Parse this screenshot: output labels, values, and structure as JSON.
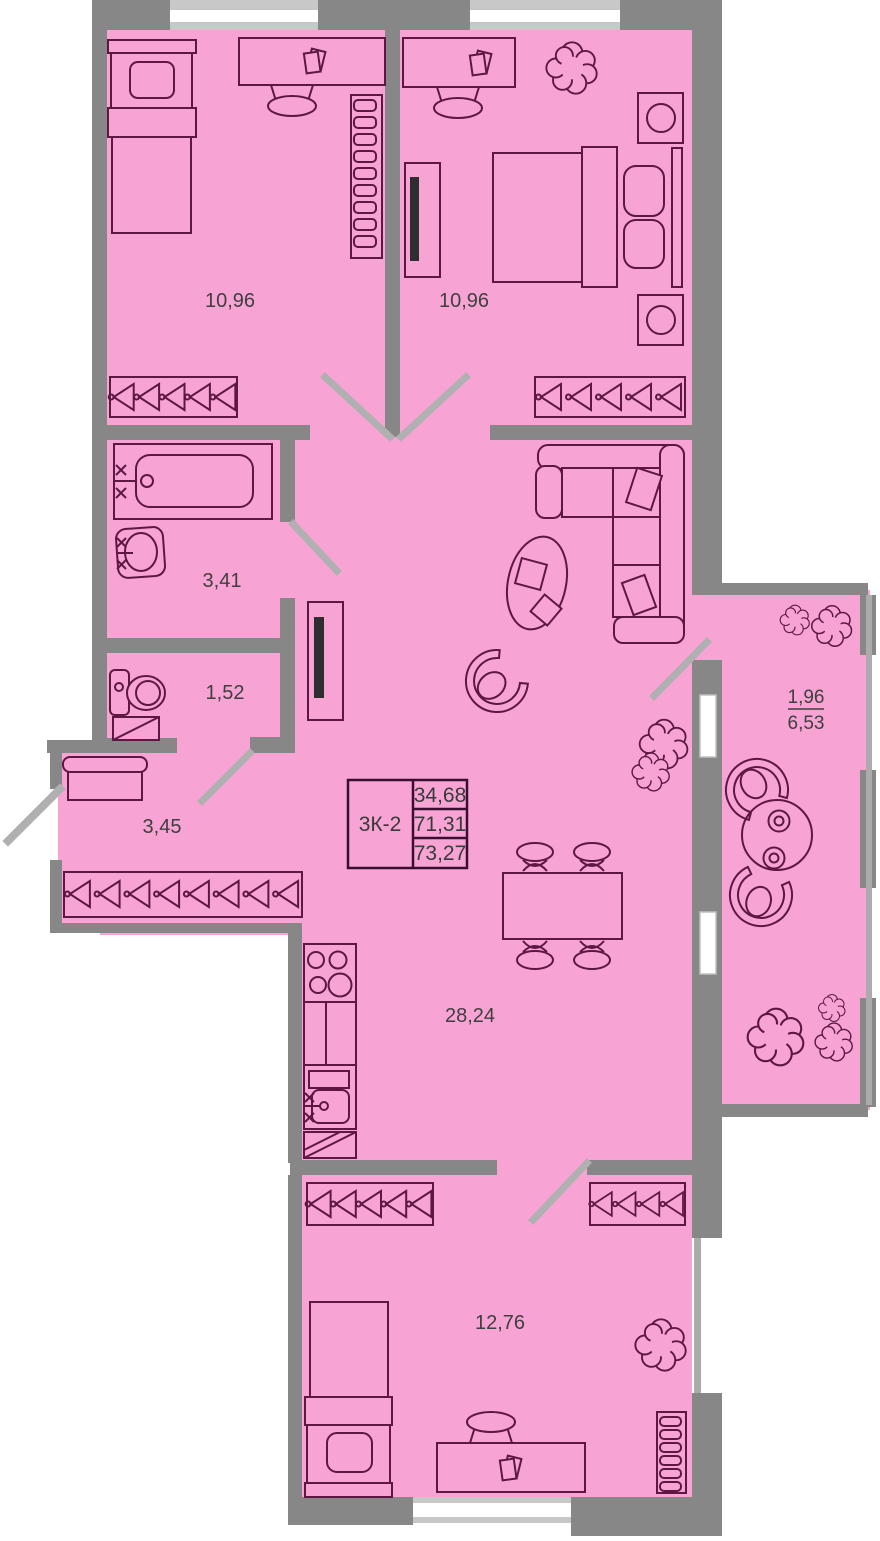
{
  "floorplan": {
    "summary": {
      "unit": "3К-2",
      "values": [
        "34,68",
        "71,31",
        "73,27"
      ]
    },
    "rooms": {
      "bedroom_left": {
        "area": "10,96"
      },
      "bedroom_right": {
        "area": "10,96"
      },
      "bathroom": {
        "area": "3,41"
      },
      "wc": {
        "area": "1,52"
      },
      "hallway": {
        "area": "3,45"
      },
      "living_kitchen": {
        "area": "28,24"
      },
      "bedroom_bottom": {
        "area": "12,76"
      },
      "balcony": {
        "coefficient": "1,96",
        "area": "6,53"
      }
    },
    "colors": {
      "floor": "#F7A4D4",
      "walls": "#878787",
      "furniture_outline": "#5E1745",
      "door_swing": "#B0B0B0",
      "window": "#FFFFFF",
      "text": "#3F3F3F"
    }
  }
}
